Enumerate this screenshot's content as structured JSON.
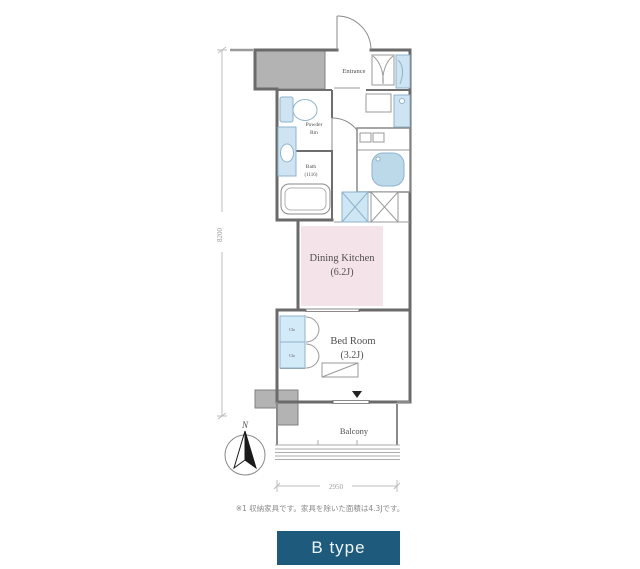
{
  "floorplan": {
    "rooms": {
      "entrance": {
        "label": "Entrance"
      },
      "powder_room": {
        "label_line1": "Powder",
        "label_line2": "Rm"
      },
      "bath": {
        "label_line1": "Bath",
        "label_line2": "(1116)"
      },
      "dining_kitchen": {
        "label": "Dining Kitchen",
        "size": "(6.2J)"
      },
      "bed_room": {
        "label": "Bed Room",
        "size": "(3.2J)"
      },
      "balcony": {
        "label": "Balcony"
      },
      "closets": {
        "upper": "Clo",
        "lower": "Clo"
      }
    },
    "compass": {
      "north": "N"
    },
    "dimensions": {
      "vertical_mm": "8200",
      "horizontal_mm": "2950"
    }
  },
  "footnote": "※1 収納家具です。家具を除いた面積は4.3Jです。",
  "badge": {
    "label": "B type",
    "background": "#1d5a7c",
    "text_color": "#eef4f7"
  },
  "colors": {
    "wall": "#6a6a6a",
    "fixture_blue_fill": "#cfe4f2",
    "fixture_blue_stroke": "#8fb3cc",
    "dining_kitchen_pink": "#f4e3e8",
    "closet_blue": "#d3eaf8",
    "concrete_gray": "#b3b3b3",
    "dimension_gray": "#a8a8a8",
    "label_gray": "#4f4f4f"
  }
}
